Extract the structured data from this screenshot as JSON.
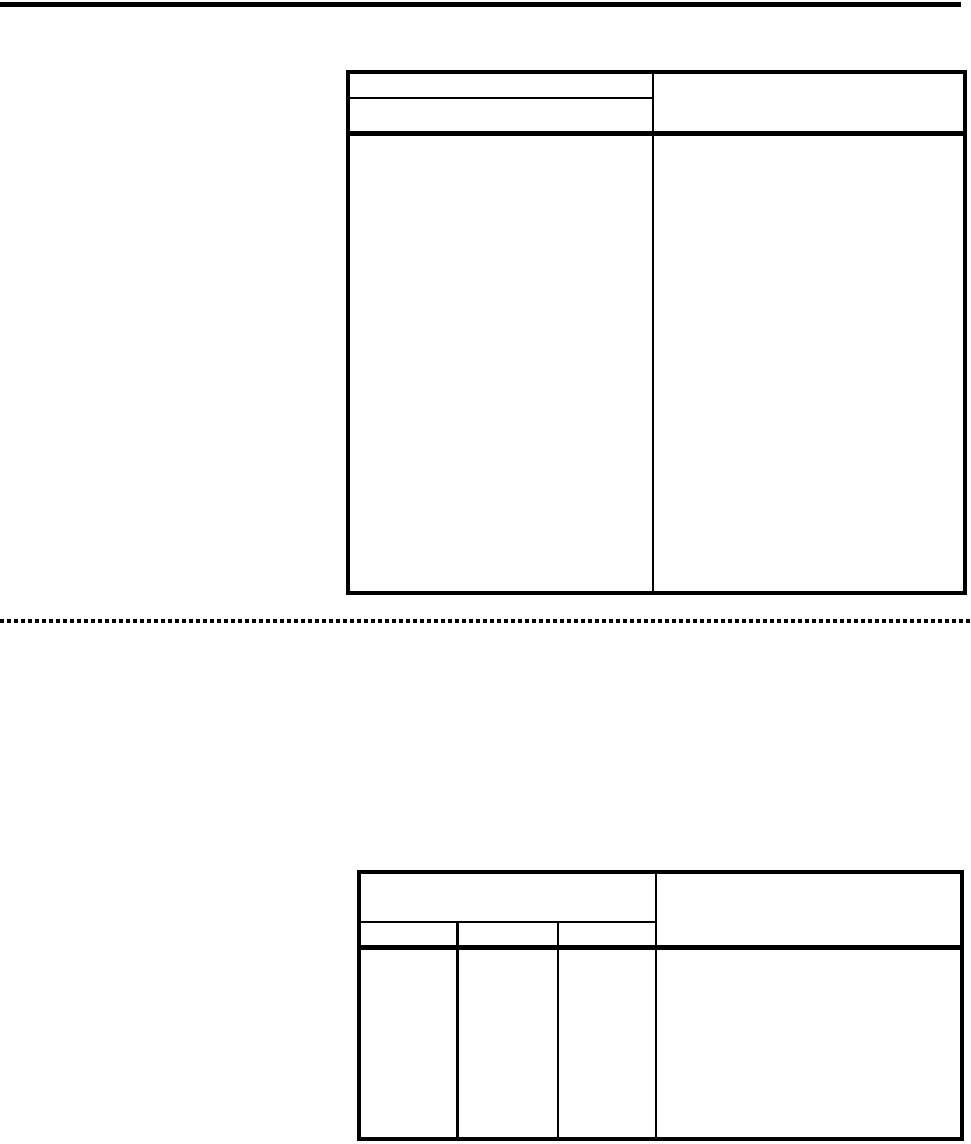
{
  "page": {
    "background_color": "#ffffff",
    "ink_color": "#000000"
  },
  "table1": {
    "header_left_row1": "",
    "header_left_row2": "",
    "header_right": "",
    "body_left": "",
    "body_right": ""
  },
  "table2": {
    "header_left": "",
    "subheader_col1": "",
    "subheader_col2": "",
    "subheader_col3": "",
    "header_right": "",
    "body_col1": "",
    "body_col2": "",
    "body_col3": "",
    "body_right": ""
  }
}
